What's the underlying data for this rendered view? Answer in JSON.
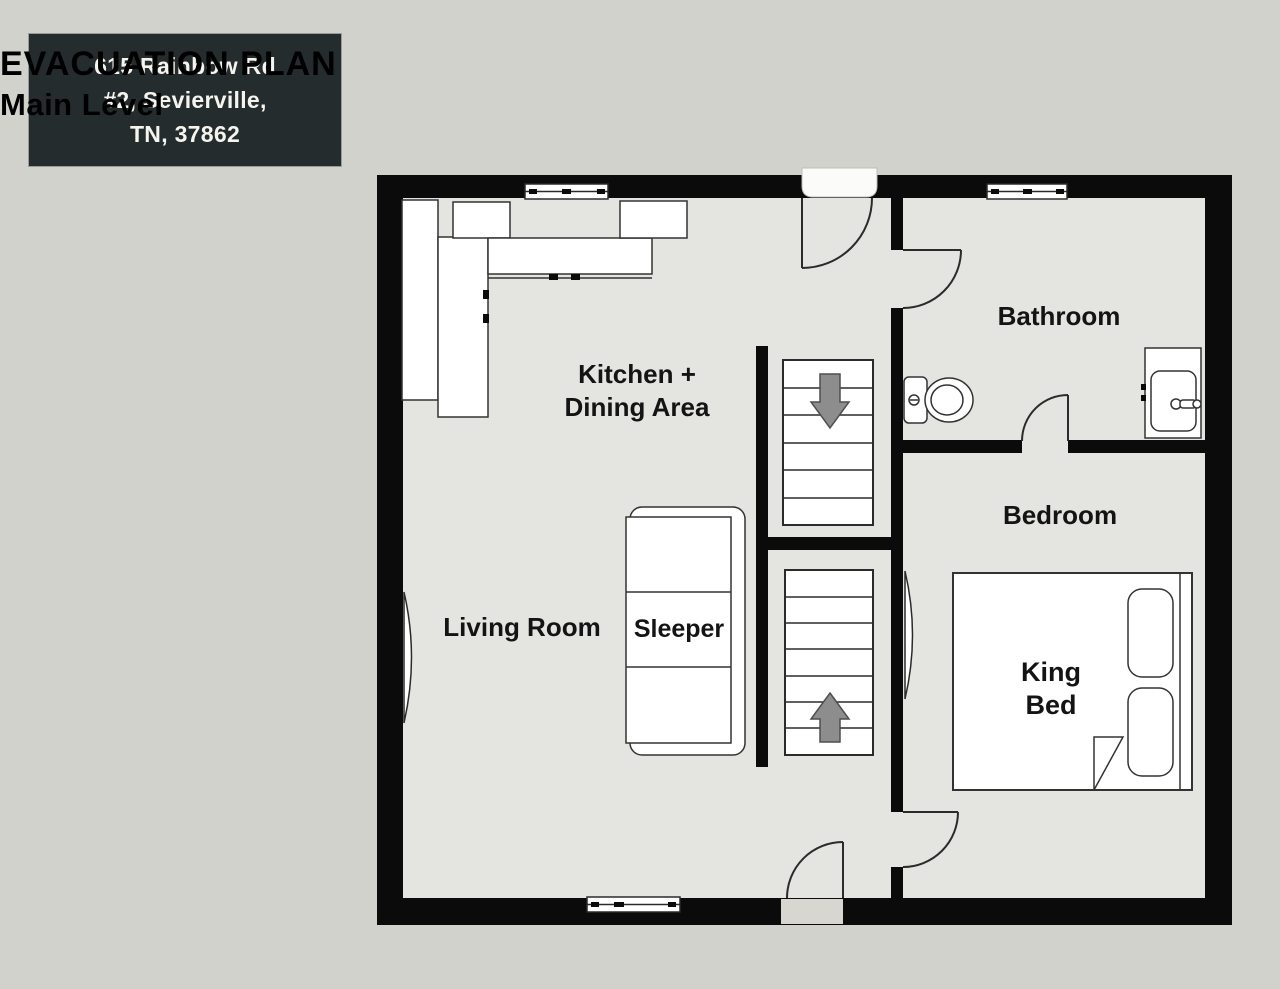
{
  "header": {
    "address_line1": "615 Rainbow Rd",
    "address_line2": "#2, Sevierville,",
    "address_line3": "TN, 37862",
    "title": "EVACUATION PLAN",
    "subtitle": "Main Level"
  },
  "floorplan": {
    "rooms": {
      "kitchen_line1": "Kitchen +",
      "kitchen_line2": "Dining Area",
      "bathroom": "Bathroom",
      "bedroom": "Bedroom",
      "living_room": "Living Room"
    },
    "furniture": {
      "sleeper": "Sleeper",
      "king_bed_line1": "King",
      "king_bed_line2": "Bed"
    },
    "stairs": {
      "upper_treads": 6,
      "lower_treads": 7,
      "upper_direction": "down",
      "lower_direction": "up"
    },
    "colors": {
      "background": "#d2d2cd",
      "floor": "#e4e4e1",
      "wall": "#0b0b0b",
      "outline": "#333333",
      "address_box": "#242c2e",
      "address_text": "#f5f4ef",
      "arrow_fill": "#8d8d8d",
      "arrow_stroke": "#4f4f4f",
      "label_text": "#141414"
    }
  }
}
